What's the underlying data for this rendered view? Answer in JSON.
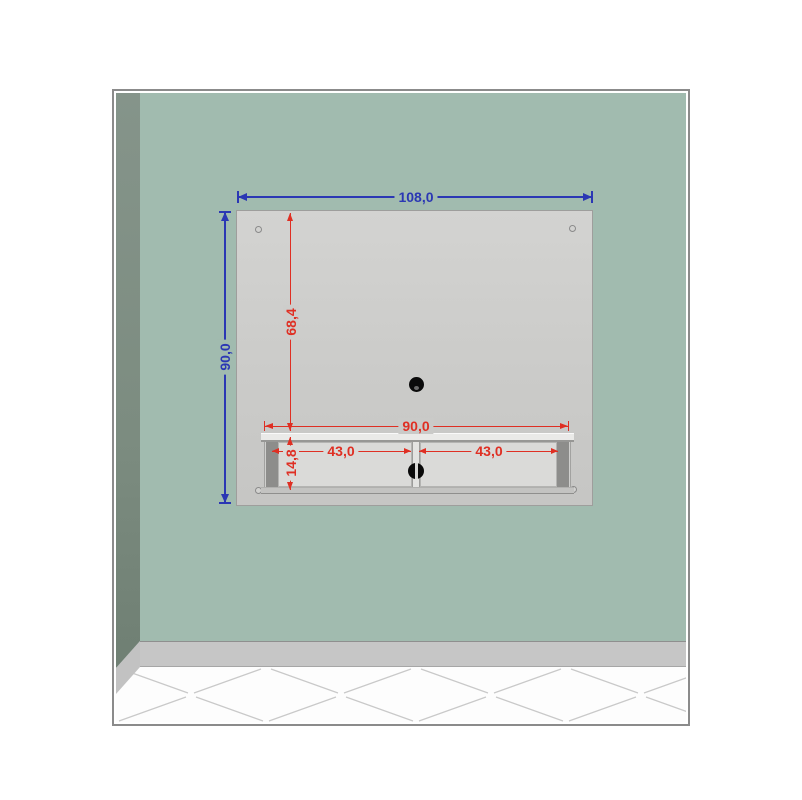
{
  "scene": {
    "subject": "wall-mounted-tv-panel-with-shelf",
    "colors": {
      "wall": "#a1bbaf",
      "side_wall": "#7c8c80",
      "baseboard": "#c6c6c6",
      "floor": "#fdfdfd",
      "floor_pattern_line": "#c9c9c9",
      "panel": "#cbcbc9",
      "door": "#dadad8",
      "dimension_blue": "#2b37b4",
      "dimension_red": "#df2f23",
      "handle": "#0a0a0a"
    }
  },
  "dimensions": {
    "panel_width": "108,0",
    "panel_height": "90,0",
    "cable_hole_offset": "68,4",
    "shelf_width": "90,0",
    "left_door_width": "43,0",
    "right_door_width": "43,0",
    "shelf_height": "14,8"
  }
}
